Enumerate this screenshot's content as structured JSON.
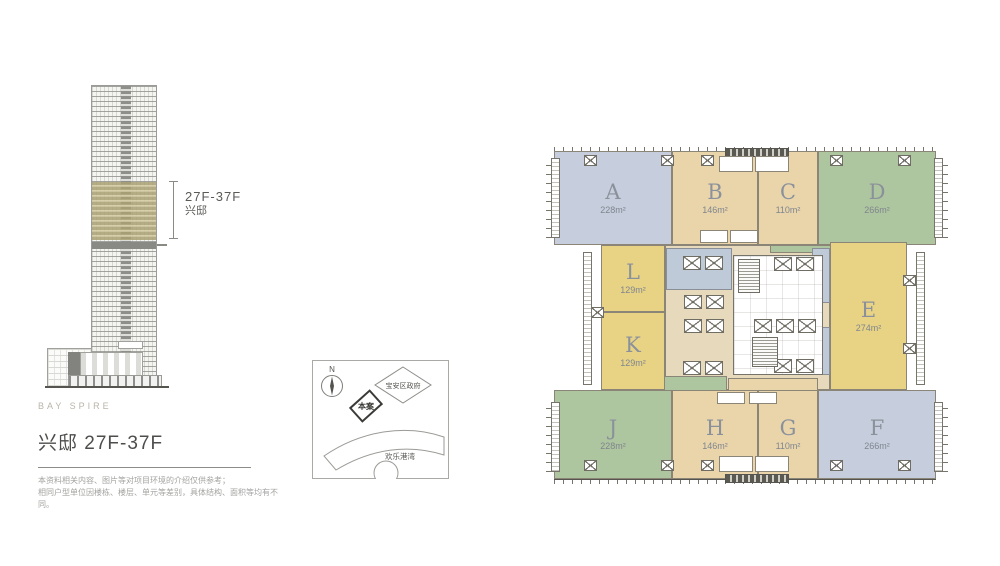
{
  "elevation": {
    "brand": "BAY SPIRE",
    "title": "兴邸 27F-37F",
    "range_label": "27F-37F",
    "range_name": "兴邸",
    "disclaimer": [
      "本资料相关内容、图片等对项目环境的介绍仅供参考；",
      "相同户型单位因楼栋、楼层、单元等差别，具体结构、面积等均有不同。"
    ]
  },
  "site_map": {
    "north_label": "N",
    "project_label": "本案",
    "landmark_government": "宝安区政府",
    "landmark_bay": "欢乐港湾"
  },
  "floor_plan": {
    "units": [
      {
        "id": "A",
        "area": "228m²",
        "color": "#c6cedd"
      },
      {
        "id": "B",
        "area": "146m²",
        "color": "#ead5ab"
      },
      {
        "id": "C",
        "area": "110m²",
        "color": "#ead5ab"
      },
      {
        "id": "D",
        "area": "266m²",
        "color": "#aec69f"
      },
      {
        "id": "L",
        "area": "129m²",
        "color": "#e8d385"
      },
      {
        "id": "K",
        "area": "129m²",
        "color": "#e8d385"
      },
      {
        "id": "E",
        "area": "274m²",
        "color": "#e8d385"
      },
      {
        "id": "J",
        "area": "228m²",
        "color": "#aec69f"
      },
      {
        "id": "H",
        "area": "146m²",
        "color": "#ead5ab"
      },
      {
        "id": "G",
        "area": "110m²",
        "color": "#ead5ab"
      },
      {
        "id": "F",
        "area": "266m²",
        "color": "#c6cedd"
      }
    ],
    "core_corridor_color": "#e7dabc",
    "core_lobby_color": "#bfcad8"
  }
}
